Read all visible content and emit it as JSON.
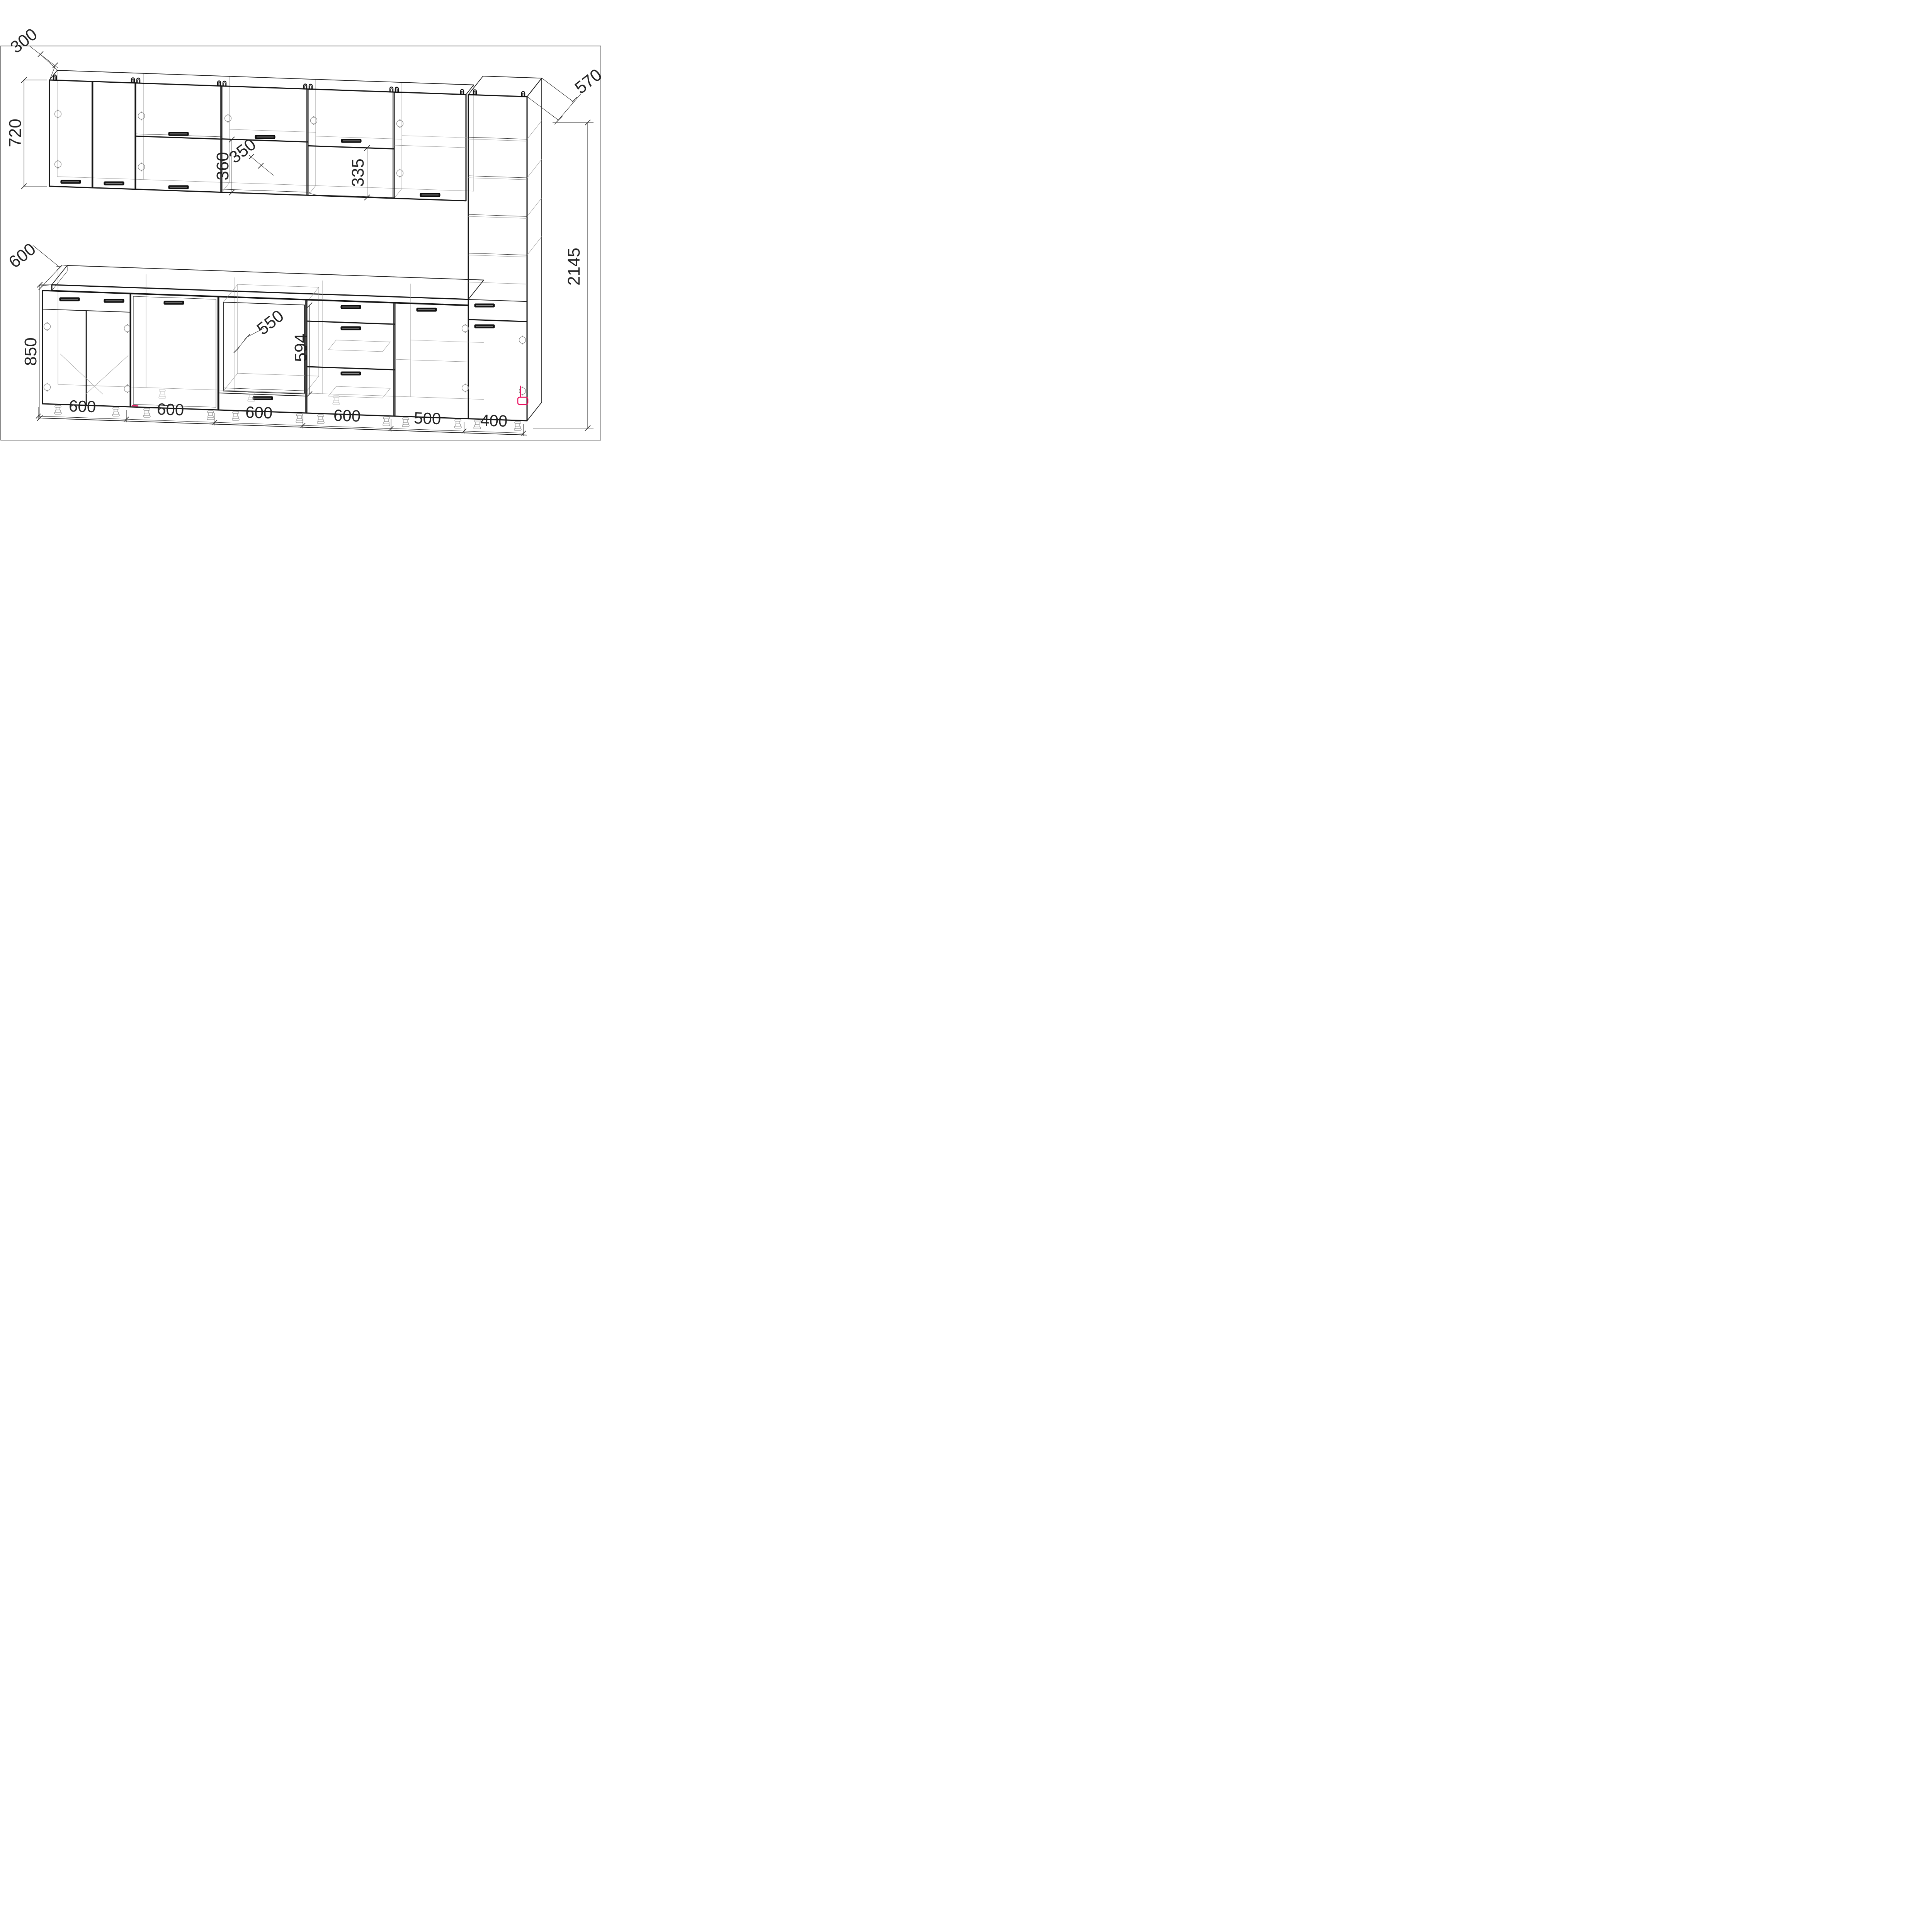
{
  "drawing": {
    "title": "kitchen-set-assembly-drawing",
    "units": "mm",
    "line_color": "#1c1c1c",
    "hidden_line_color": "#9b9b9b",
    "accent_color": "#ec1261",
    "dims": {
      "wall_depth": "300",
      "wall_height": "720",
      "niche_c_height": "360",
      "niche_shelf_depth": "350",
      "niche_d_height": "335",
      "tall_depth": "570",
      "tall_height": "2145",
      "counter_depth": "600",
      "base_height": "850",
      "oven_niche_depth": "550",
      "oven_niche_height": "594",
      "bottom": [
        "600",
        "600",
        "600",
        "600",
        "500",
        "400"
      ]
    },
    "cabinets": {
      "wall_row": [
        {
          "id": "W1",
          "width_mm": 600,
          "type": "two-door wall cabinet, handles at door bottoms"
        },
        {
          "id": "W2",
          "width_mm": 600,
          "type": "two stacked flip-up doors with center handles"
        },
        {
          "id": "W3",
          "width_mm": 600,
          "type": "flip-up door over open niche 360 mm high"
        },
        {
          "id": "W4",
          "width_mm": 600,
          "type": "flip-up door over open niche 335 mm high, radiused shelf"
        },
        {
          "id": "W5",
          "width_mm": 500,
          "type": "single-door wall cabinet with internal shelf"
        }
      ],
      "tall_unit": {
        "id": "T1",
        "width_mm": 400,
        "depth_mm": 570,
        "height_mm": 2145,
        "type": "open shelving column with drawer and door below counter level"
      },
      "base_row": [
        {
          "id": "B1",
          "width_mm": 600,
          "type": "sink base: two false drawer fronts, two doors, corner braces"
        },
        {
          "id": "B2",
          "width_mm": 600,
          "type": "full-front appliance (dishwasher) door, handle on top"
        },
        {
          "id": "B3",
          "width_mm": 600,
          "type": "oven housing: open niche 594 x 550 with drawer below"
        },
        {
          "id": "B4",
          "width_mm": 600,
          "type": "three-drawer base unit"
        },
        {
          "id": "B5",
          "width_mm": 500,
          "type": "single-door base cabinet with shelf"
        }
      ],
      "countertop": {
        "depth_mm": 600,
        "top_height_mm": 850
      }
    }
  }
}
